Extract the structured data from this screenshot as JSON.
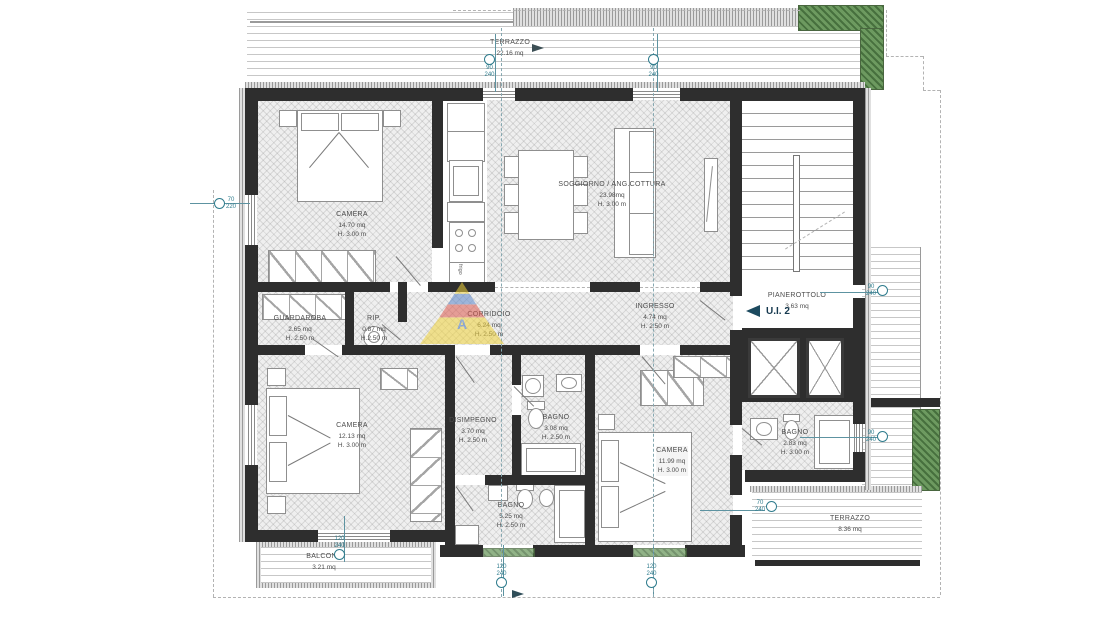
{
  "unit": {
    "label": "U.I. 2"
  },
  "watermark": {
    "letter": "A"
  },
  "appliances": {
    "frigo": "frigo"
  },
  "colors": {
    "wall": "#2e2e2e",
    "marker_teal": "#2f7c8d",
    "planter_green": "#6d9a60",
    "unit_arrow": "#1c4a5f",
    "watermark_yellow": "#f0d23c",
    "watermark_red": "#dd5b4f",
    "watermark_blue": "#5b86c9"
  },
  "rooms": {
    "terrazzo_top": {
      "name": "TERRAZZO",
      "area": "22.16 mq"
    },
    "camera1": {
      "name": "CAMERA",
      "area": "14.70 mq",
      "height": "H. 3.00 m"
    },
    "soggiorno": {
      "name": "SOGGIORNO / ANG.COTTURA",
      "area": "23.98mq",
      "height": "H. 3.00 m"
    },
    "pianerottolo": {
      "name": "PIANEROTTOLO",
      "area": "3.63 mq"
    },
    "guardaroba": {
      "name": "GUARDAROBA",
      "area": "2.65 mq",
      "height": "H. 2.50 m"
    },
    "rip": {
      "name": "RIP.",
      "area": "0.87 mq",
      "height": "H.2.50 m"
    },
    "corridoio": {
      "name": "CORRIDOIO",
      "area": "6.24 mq",
      "height": "H. 2.50 m"
    },
    "ingresso": {
      "name": "INGRESSO",
      "area": "4.74 mq",
      "height": "H. 2.50 m"
    },
    "camera2": {
      "name": "CAMERA",
      "area": "12.13 mq",
      "height": "H. 3.00 m"
    },
    "disimpegno": {
      "name": "DISIMPEGNO",
      "area": "3.70 mq",
      "height": "H. 2.50 m"
    },
    "bagno_centro": {
      "name": "BAGNO",
      "area": "3.08 mq",
      "height": "H. 2.50 m"
    },
    "camera3": {
      "name": "CAMERA",
      "area": "11.99 mq",
      "height": "H. 3.00 m"
    },
    "bagno_est": {
      "name": "BAGNO",
      "area": "2.83 mq",
      "height": "H. 3.00 m"
    },
    "bagno_sud": {
      "name": "BAGNO",
      "area": "5.25 mq",
      "height": "H. 2.50 m"
    },
    "balcone": {
      "name": "BALCONE",
      "area": "3.21 mq"
    },
    "terrazzo_sud": {
      "name": "TERRAZZO",
      "area": "8.36 mq"
    }
  },
  "markers": {
    "top_left": "90\n240",
    "top_right": "90\n240",
    "west": "70\n220",
    "balcone": "120\n240",
    "south_left": "120\n240",
    "south_right": "120\n240",
    "east_landing": "90\n240",
    "east_bath": "90\n240",
    "terrace_south": "70\n240"
  }
}
